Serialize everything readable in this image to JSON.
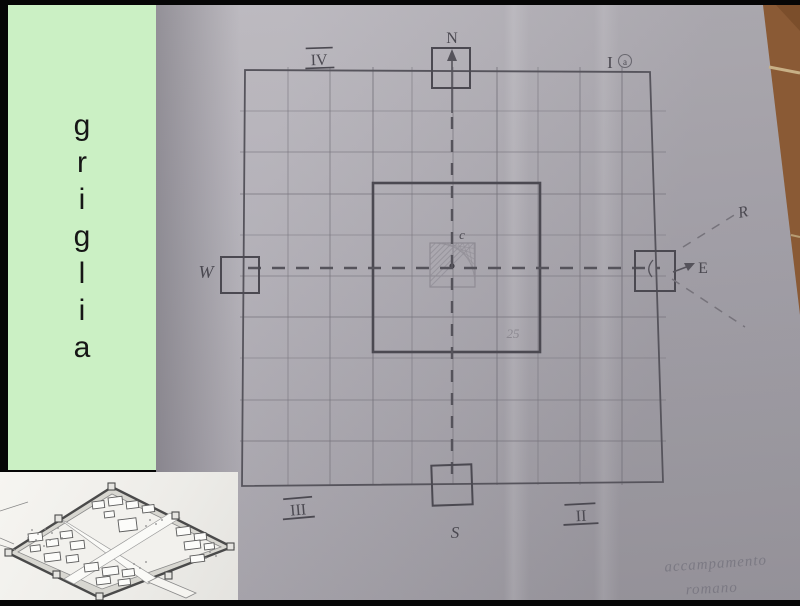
{
  "banner": {
    "word": "griglia",
    "letters": [
      "g",
      "r",
      "i",
      "g",
      "l",
      "i",
      "a"
    ],
    "bg_color": "#cbf0c4",
    "text_color": "#161616"
  },
  "sketch": {
    "compass": {
      "north": "N",
      "south": "S",
      "west": "W",
      "east": "E"
    },
    "quadrants": {
      "q1": "I",
      "q1_sub": "a",
      "q2": "II",
      "q3": "III",
      "q4": "IV"
    },
    "center_label": "c",
    "side_length_label": "25",
    "ray_label": "R",
    "caption_line1": "accampamento",
    "caption_line2": "romano"
  },
  "colors": {
    "paper": "#aaa7af",
    "pencil_dark": "#4b4951",
    "pencil_light": "#8b8890",
    "tile_brown": "#8a5a35",
    "tile_grout": "#c8b086",
    "inset_bg": "#f3f2ee",
    "banner_green": "#cbf0c4"
  }
}
